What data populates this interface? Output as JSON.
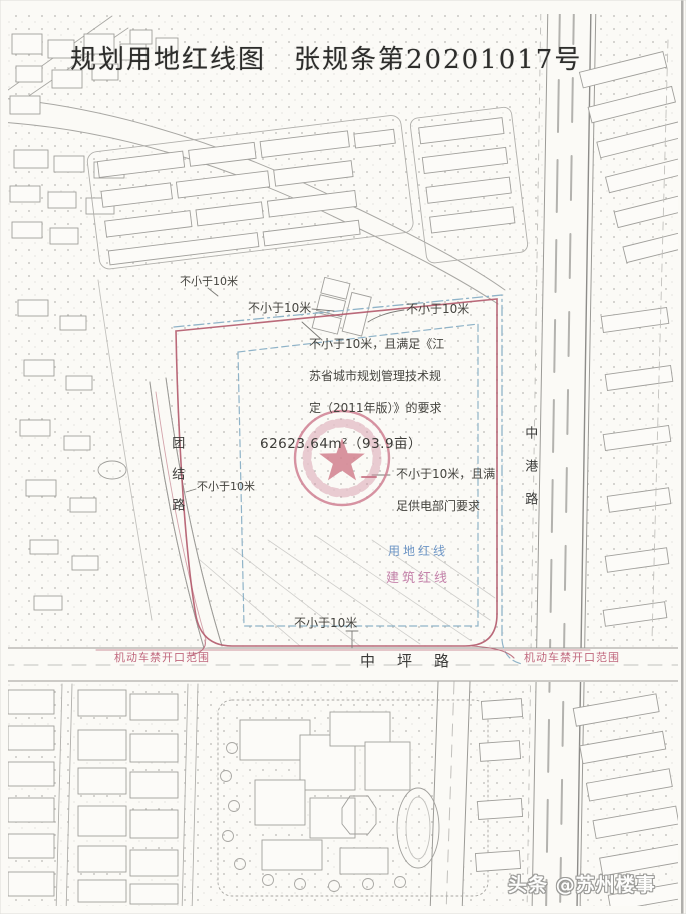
{
  "page": {
    "title": "规划用地红线图　张规条第20201017号"
  },
  "parcel": {
    "area": "62623.64m²（93.9亩）",
    "setback_top_left": "不小于10米",
    "setback_top_mid": "不小于10米",
    "setback_top_right": "不小于10米",
    "setback_left": "不小于10米",
    "setback_bottom": "不小于10米",
    "note_regulation": {
      "line1": "不小于10米，且满足《江",
      "line2": "苏省城市规划管理技术规",
      "line3": "定（2011年版）》的要求"
    },
    "note_power": {
      "line1": "不小于10米，且满",
      "line2": "足供电部门要求"
    },
    "legend_land": "用地红线",
    "legend_building": "建筑红线"
  },
  "roads": {
    "left_vertical": "团结路",
    "right_vertical": "中港路",
    "bottom_horizontal": "中坪路"
  },
  "restrictions": {
    "no_opening_left": "机动车禁开口范围",
    "no_opening_right": "机动车禁开口范围"
  },
  "watermark": "头条 @苏州楼事",
  "colors": {
    "paper": "#fbfaf6",
    "linework_gray": "#9c9b97",
    "red_line": "#b2596b",
    "blue_line": "#8fb3c8",
    "stamp": "#cf7f92",
    "legend_land_blue": "#6d95c5",
    "legend_building_pink": "#c583ab",
    "restriction_red": "#c0677d"
  }
}
